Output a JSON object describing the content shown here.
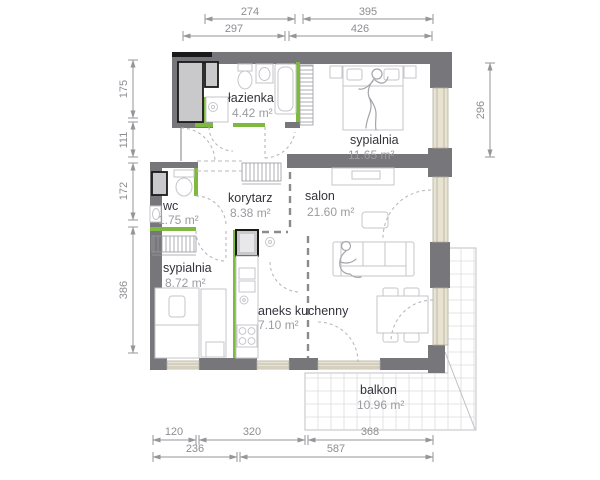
{
  "plan": {
    "type": "apartment-floor-plan",
    "rooms": [
      {
        "id": "lazienka",
        "name": "łazienka",
        "area": "4.42 m²"
      },
      {
        "id": "sypialnia-1",
        "name": "sypialnia",
        "area": "11.65 m²"
      },
      {
        "id": "wc",
        "name": "wc",
        "area": "1.75 m²"
      },
      {
        "id": "korytarz",
        "name": "korytarz",
        "area": "8.38 m²"
      },
      {
        "id": "salon",
        "name": "salon",
        "area": "21.60 m²"
      },
      {
        "id": "sypialnia-2",
        "name": "sypialnia",
        "area": "8.72 m²"
      },
      {
        "id": "aneks",
        "name": "aneks kuchenny",
        "area": "7.10 m²"
      },
      {
        "id": "balkon",
        "name": "balkon",
        "area": "10.96 m²"
      }
    ],
    "dims": {
      "top_row1": [
        "274",
        "395"
      ],
      "top_row2": [
        "297",
        "426"
      ],
      "left": [
        "175",
        "111",
        "172",
        "386"
      ],
      "right": [
        "296"
      ],
      "bottom_row1": [
        "120",
        "320",
        "368"
      ],
      "bottom_row2": [
        "236",
        "587"
      ]
    },
    "colors": {
      "wall": "#76767b",
      "wall_black": "#1a1a1a",
      "green_wall": "#7fb93f",
      "window": "#e8e3d1",
      "furniture_line": "#c6c6ca",
      "dimension": "#8e8e93"
    }
  }
}
